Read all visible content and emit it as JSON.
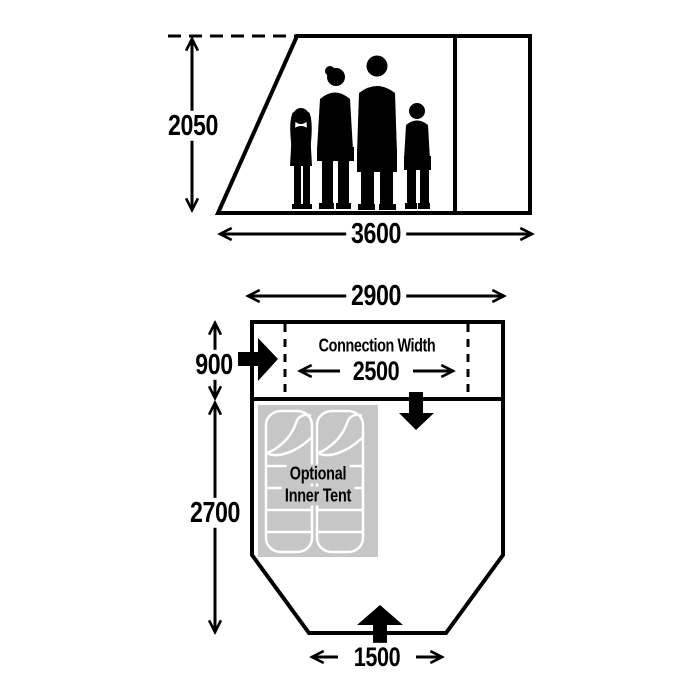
{
  "side_view": {
    "height_label": "2050",
    "width_label": "3600"
  },
  "floor_plan": {
    "top_width_label": "2900",
    "connection_depth_label": "900",
    "connection_width_title": "Connection Width",
    "connection_width_value": "2500",
    "main_depth_label": "2700",
    "entrance_width_label": "1500",
    "inner_tent": {
      "line1": "Optional",
      "line2": "Inner Tent"
    }
  },
  "icons": {
    "connection_entry": "arrow-right",
    "connection_exit": "arrow-down",
    "main_entrance": "arrow-up"
  },
  "colors": {
    "line": "#000000",
    "background": "#ffffff",
    "inner_tent_fill": "#c6c6c6",
    "sleeping_bag_outline": "#ffffff",
    "silhouette": "#000000"
  }
}
